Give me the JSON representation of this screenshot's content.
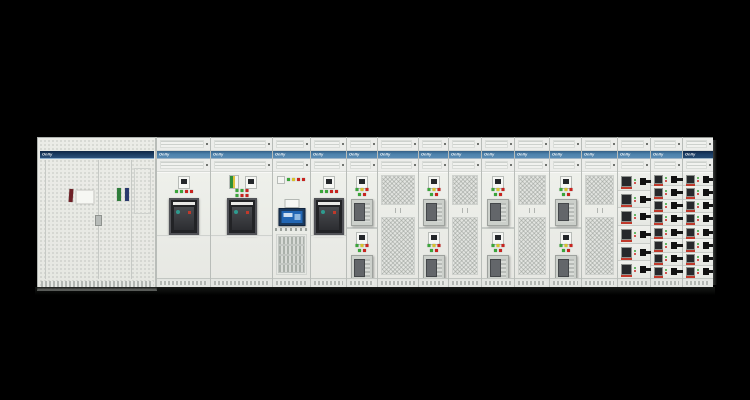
{
  "brand": {
    "logo_text": "Onlly"
  },
  "colors": {
    "background": "#000000",
    "cabinet_face": "#e9eae5",
    "band_blue": "#4d82ac",
    "band_navy": "#1b3f68",
    "mesh_gray": "#e2e4e0",
    "acb_window": "#222326",
    "hmi_screen": "#2266b4",
    "handle_black": "#111111",
    "indicator": {
      "green": "#3aa53a",
      "yellow": "#d6c32c",
      "red": "#c8241f"
    }
  },
  "lineup": {
    "left_cabinet": {
      "logo": "Onlly",
      "band": "navy",
      "labels": [
        {
          "name": "door-label-maroon",
          "color": "#6e2026"
        },
        {
          "name": "door-label-white",
          "color": "#f6f7f3"
        },
        {
          "name": "door-label-green",
          "color": "#2f7d3b"
        },
        {
          "name": "door-label-navy",
          "color": "#2a3a6e"
        }
      ]
    },
    "sections": [
      {
        "type": "acb",
        "width": 53,
        "band": "blue",
        "logo": "Onlly",
        "indicators": [
          "green",
          "green",
          "red",
          "red"
        ]
      },
      {
        "type": "acb2",
        "width": 61,
        "band": "blue",
        "logo": "Onlly",
        "indicators": [
          "green",
          "green",
          "red"
        ],
        "indicators2": [
          "green",
          "red",
          "red"
        ]
      },
      {
        "type": "hmi",
        "width": 37,
        "band": "blue",
        "logo": "Onlly",
        "indicators": [
          "green",
          "yellow",
          "red",
          "red"
        ]
      },
      {
        "type": "acb",
        "width": 35,
        "band": "blue",
        "logo": "Onlly",
        "indicators": [
          "green",
          "green",
          "red",
          "red"
        ]
      },
      {
        "type": "mcc2",
        "width": 30,
        "band": "blue",
        "logo": "Onlly",
        "indicators": [
          "green",
          "yellow",
          "red"
        ],
        "indicators2": [
          "green",
          "red"
        ]
      },
      {
        "type": "mesh",
        "width": 40,
        "band": "blue",
        "logo": "Onlly"
      },
      {
        "type": "mcc2",
        "width": 29,
        "band": "blue",
        "logo": "Onlly",
        "indicators": [
          "green",
          "yellow",
          "red"
        ],
        "indicators2": [
          "green",
          "red"
        ]
      },
      {
        "type": "mesh",
        "width": 32,
        "band": "blue",
        "logo": "Onlly"
      },
      {
        "type": "mcc2",
        "width": 32,
        "band": "blue",
        "logo": "Onlly",
        "indicators": [
          "green",
          "yellow",
          "red"
        ],
        "indicators2": [
          "green",
          "red"
        ]
      },
      {
        "type": "mesh",
        "width": 34,
        "band": "blue",
        "logo": "Onlly"
      },
      {
        "type": "mcc2",
        "width": 31,
        "band": "blue",
        "logo": "Onlly",
        "indicators": [
          "green",
          "yellow",
          "red"
        ],
        "indicators2": [
          "green",
          "red"
        ]
      },
      {
        "type": "mesh",
        "width": 35,
        "band": "blue",
        "logo": "Onlly"
      },
      {
        "type": "feeder",
        "width": 32,
        "rows": 6,
        "band": "blue",
        "logo": "Onlly",
        "indicators": [
          "green",
          "red"
        ]
      },
      {
        "type": "feeder",
        "width": 31,
        "rows": 8,
        "band": "blue",
        "logo": "Onlly",
        "indicators": [
          "green",
          "red"
        ]
      },
      {
        "type": "feeder",
        "width": 30,
        "rows": 8,
        "band": "navy",
        "logo": "Onlly",
        "indicators": [
          "green",
          "red"
        ]
      }
    ]
  }
}
